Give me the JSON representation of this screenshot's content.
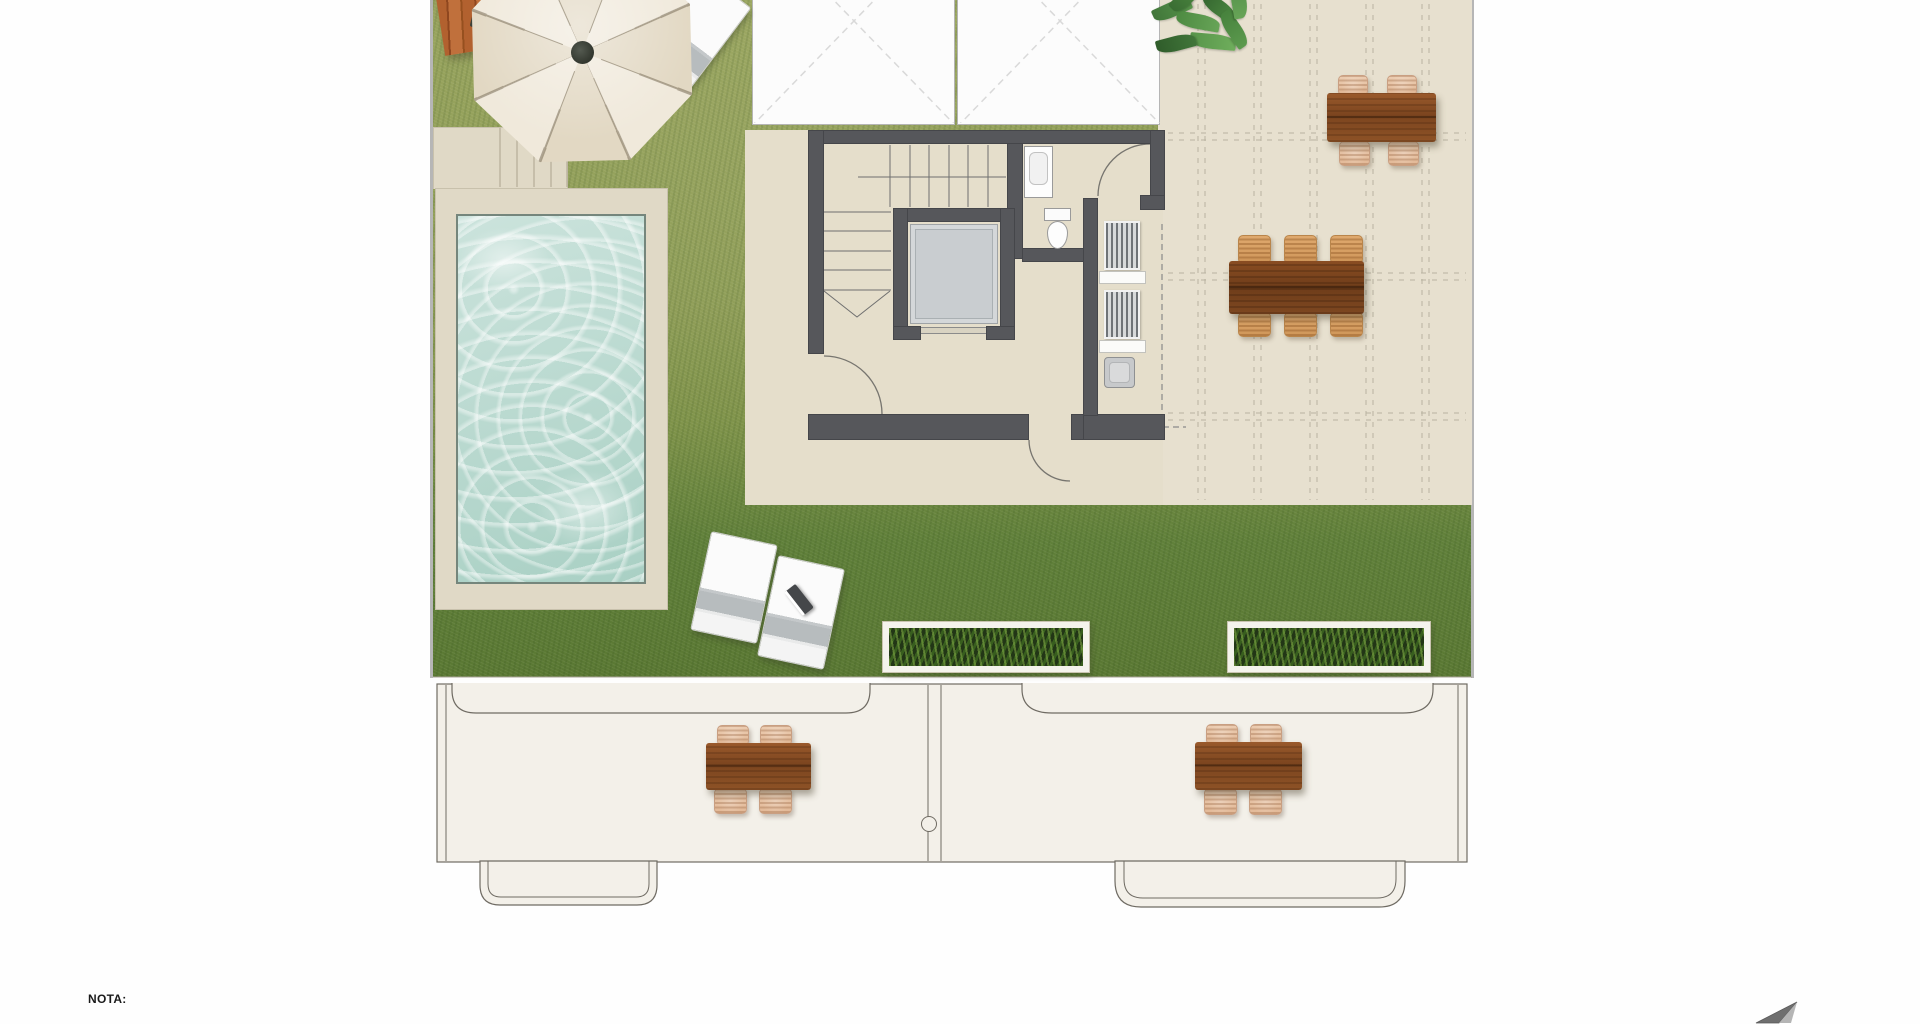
{
  "note": {
    "label": "NOTA:"
  },
  "palette": {
    "grass": "#87994e",
    "grass_dark": "#5e7c35",
    "floor_beige": "#e5decb",
    "tile_beige": "#e7e0cf",
    "deck_beige": "#e0d9c6",
    "wall": "#56575b",
    "water": "#b9d8cf",
    "terrace_floor": "#f3f0e9",
    "wood_table": "#8a4f28",
    "wicker": "#e8c6ab",
    "parasol": "#ece3d2"
  },
  "plan": {
    "type": "roof-terrace-floor-plan",
    "zones": [
      "garden-lawn",
      "swimming-pool",
      "pool-deck",
      "building-core-stairs-elevator-bathroom",
      "tiled-terrace",
      "lower-terraces"
    ],
    "furniture_counts": {
      "parasol": 1,
      "sun_loungers": 3,
      "dining_tables": 5,
      "planter_boxes": 2,
      "potted_plants": 1
    }
  }
}
